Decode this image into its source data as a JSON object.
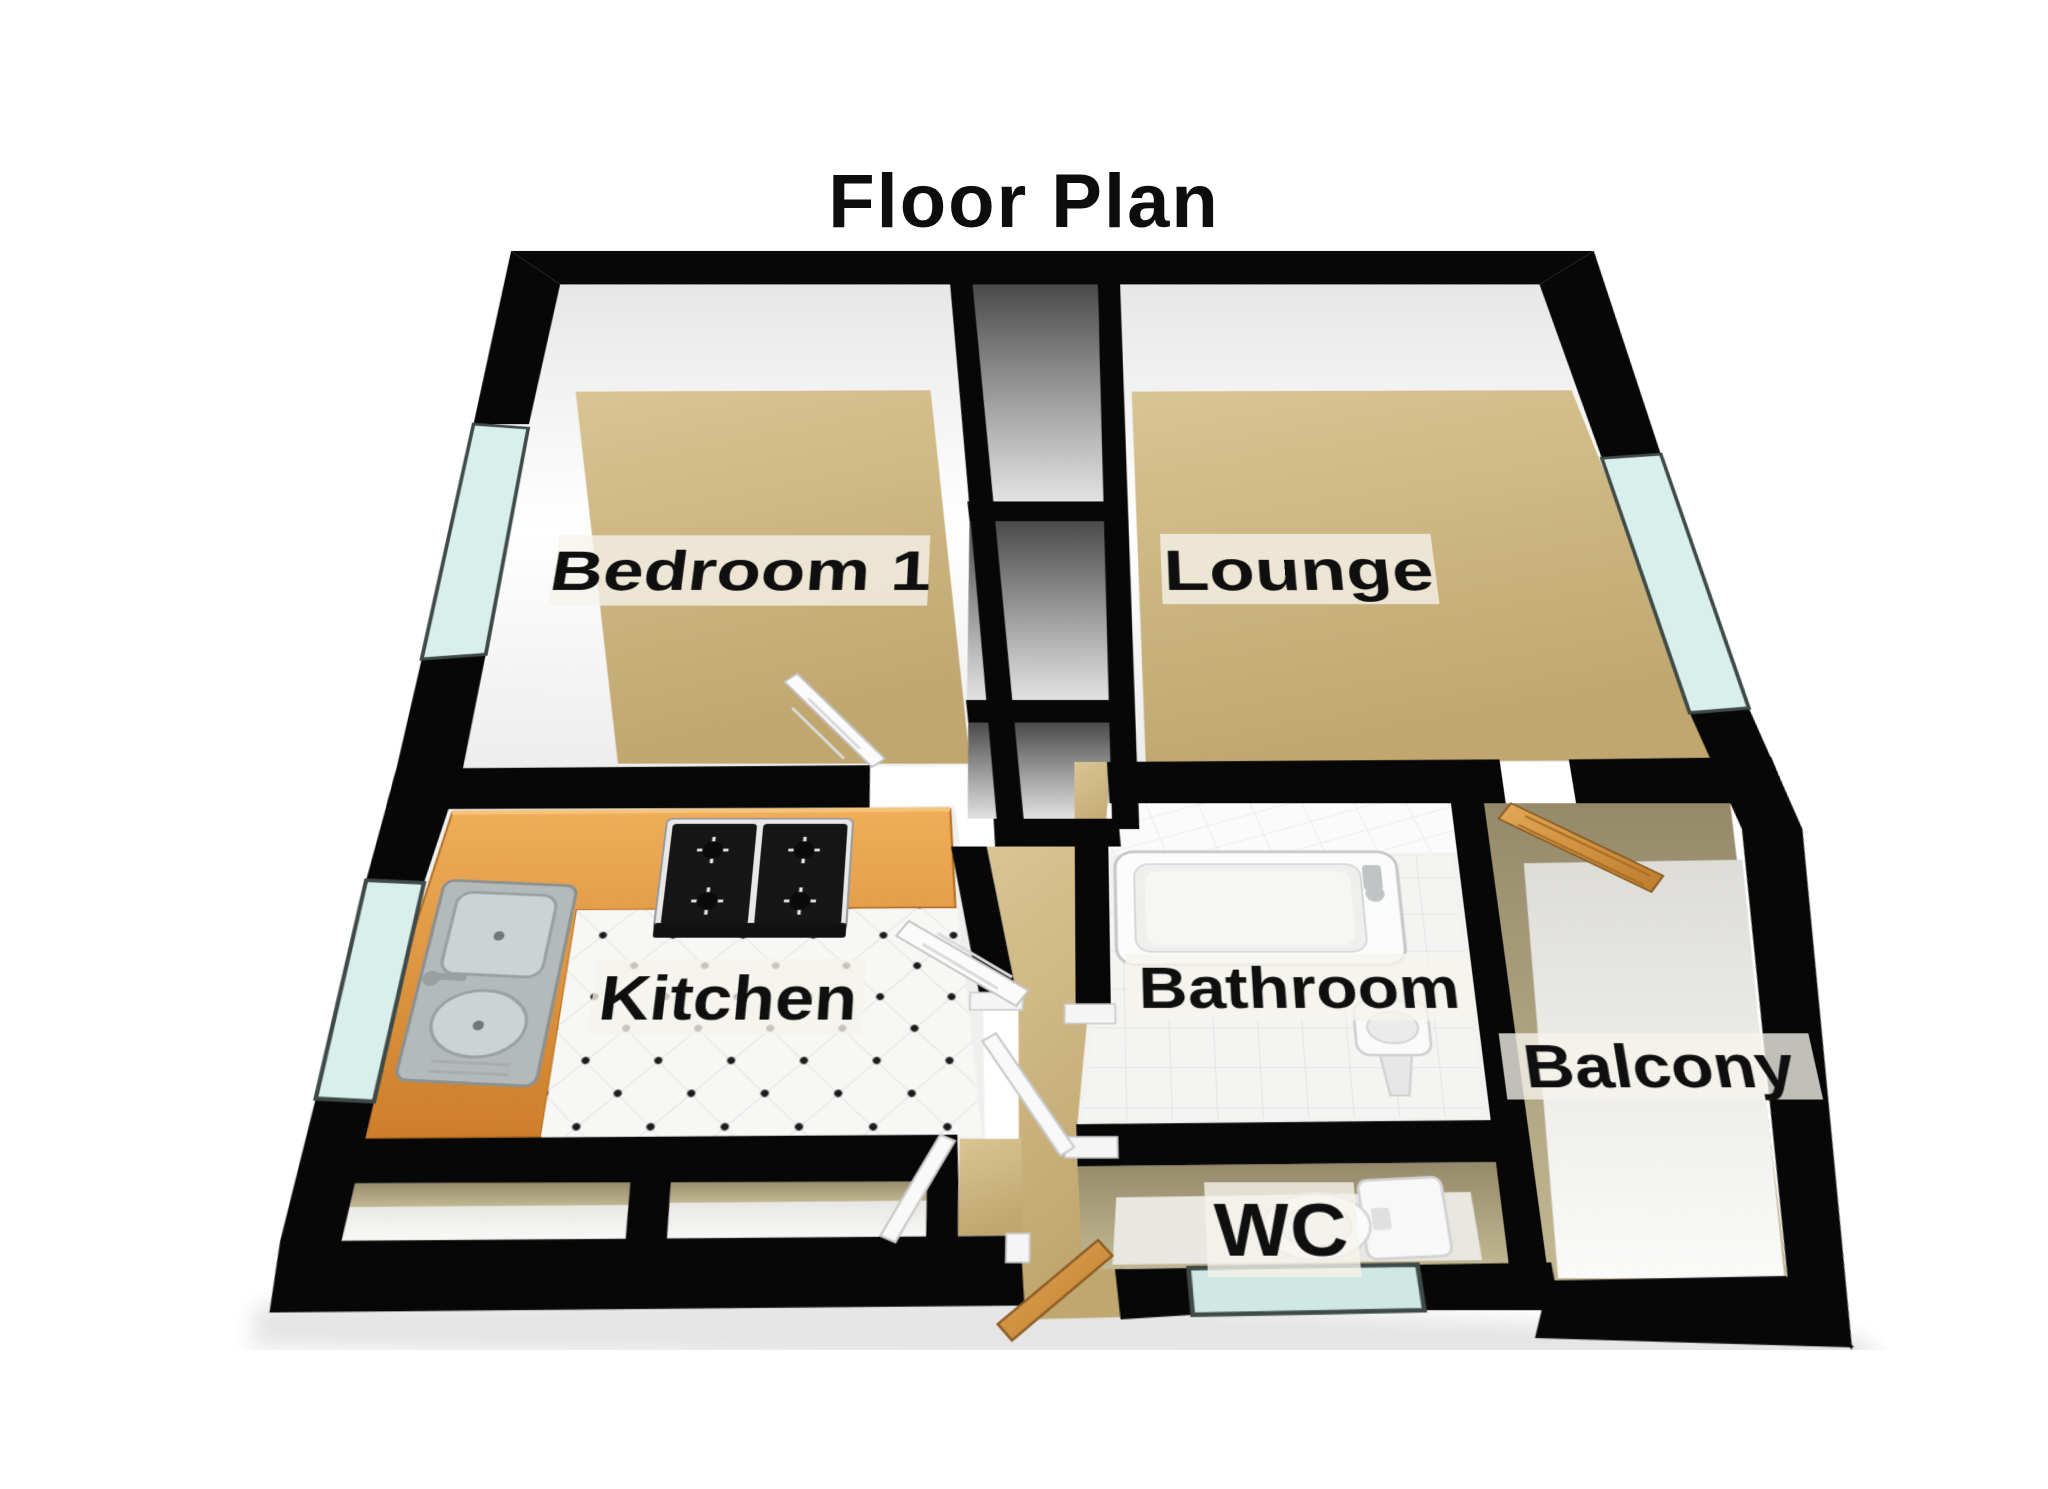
{
  "title": "Floor Plan",
  "rooms": [
    {
      "name": "bedroom-1",
      "label": "Bedroom 1"
    },
    {
      "name": "lounge",
      "label": "Lounge"
    },
    {
      "name": "kitchen",
      "label": "Kitchen"
    },
    {
      "name": "bathroom",
      "label": "Bathroom"
    },
    {
      "name": "balcony",
      "label": "Balcony"
    },
    {
      "name": "wc",
      "label": "WC"
    }
  ],
  "fixtures": [
    "kitchen-counter",
    "kitchen-sink",
    "gas-hob",
    "bathtub",
    "bath-tap",
    "pedestal-basin",
    "toilet",
    "storage-closets",
    "bedroom-window",
    "kitchen-window",
    "lounge-window",
    "wc-window",
    "bedroom-door",
    "kitchen-door",
    "bathroom-door",
    "storage-door",
    "front-door",
    "balcony-door"
  ],
  "colors": {
    "wall_black": "#070707",
    "inner_wall_white": "#f6f6f6",
    "carpet_tan": "#cdb47f",
    "hall_tan": "#c6ad7a",
    "khaki_wall": "#a39878",
    "counter_orange": "#e6a04b",
    "wood_door": "#d2984a",
    "window_glass": "#d9efec",
    "window_frame": "#3e4a47",
    "tile_white": "#f6f6f5",
    "label_background": "rgba(246,244,236,0.78)",
    "label_text": "#0f0f0f"
  }
}
